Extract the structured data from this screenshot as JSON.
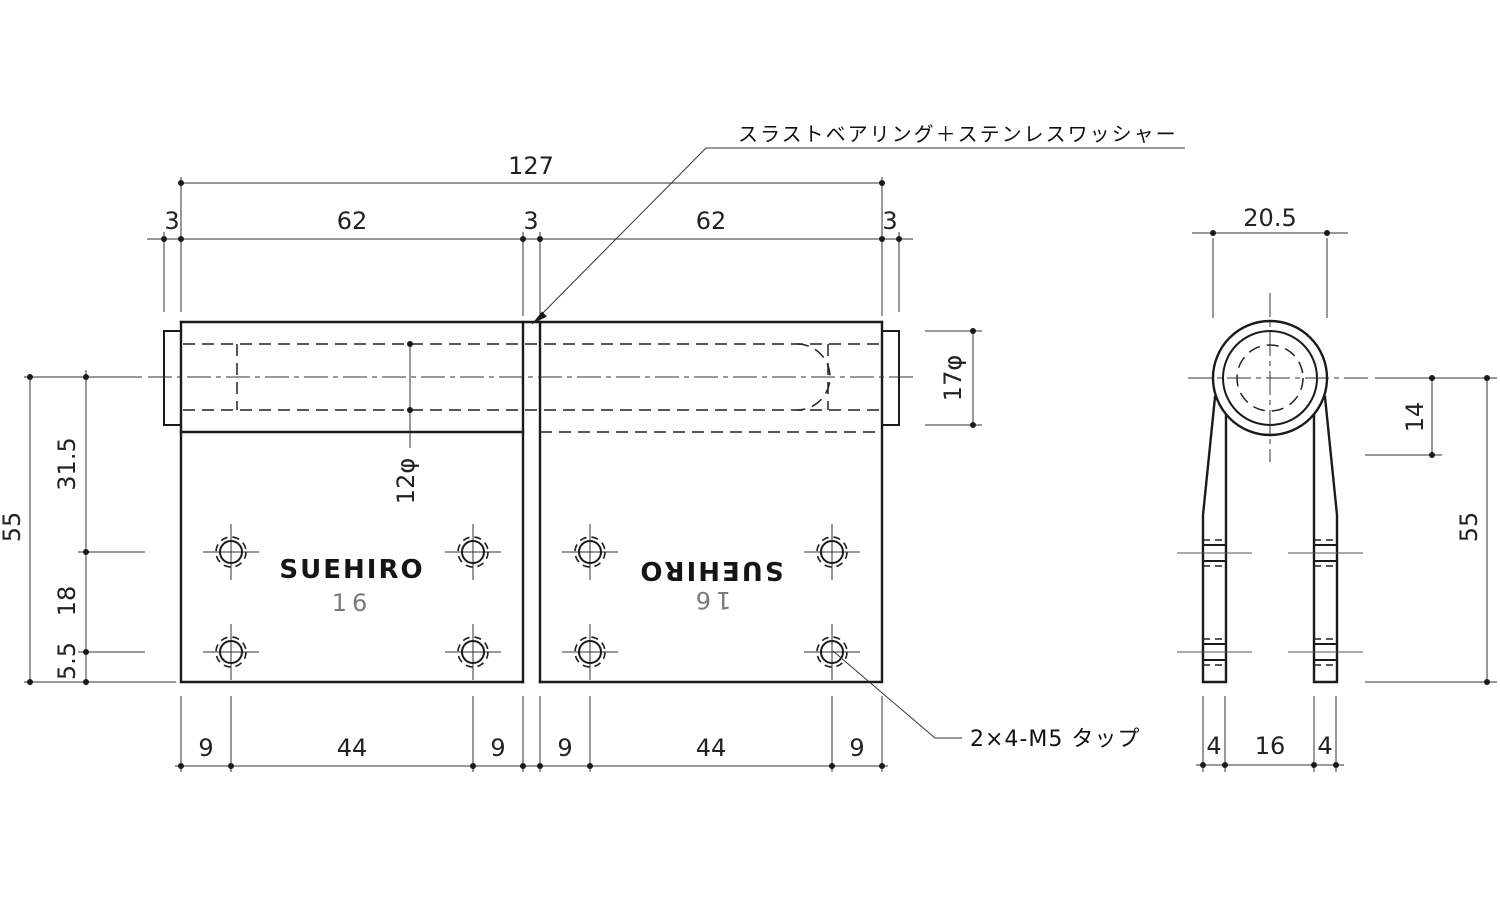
{
  "labels": {
    "bearing_note": "スラストベアリング＋ステンレスワッシャー",
    "tap_note": "2×4-M5 タップ"
  },
  "logo": {
    "brand": "SUEHIRO",
    "model": "16"
  },
  "front": {
    "overall_width": "127",
    "top_segments": [
      "3",
      "62",
      "3",
      "62",
      "3"
    ],
    "overall_height": "55",
    "left_segments": [
      "31.5",
      "18",
      "5.5"
    ],
    "barrel_dia": "17φ",
    "bore_dia": "12φ",
    "bottom_segments": [
      "9",
      "44",
      "9",
      "9",
      "44",
      "9"
    ]
  },
  "side": {
    "knuckle_width": "20.5",
    "center_offset": "14",
    "height": "55",
    "bottom_segments": [
      "4",
      "16",
      "4"
    ]
  }
}
